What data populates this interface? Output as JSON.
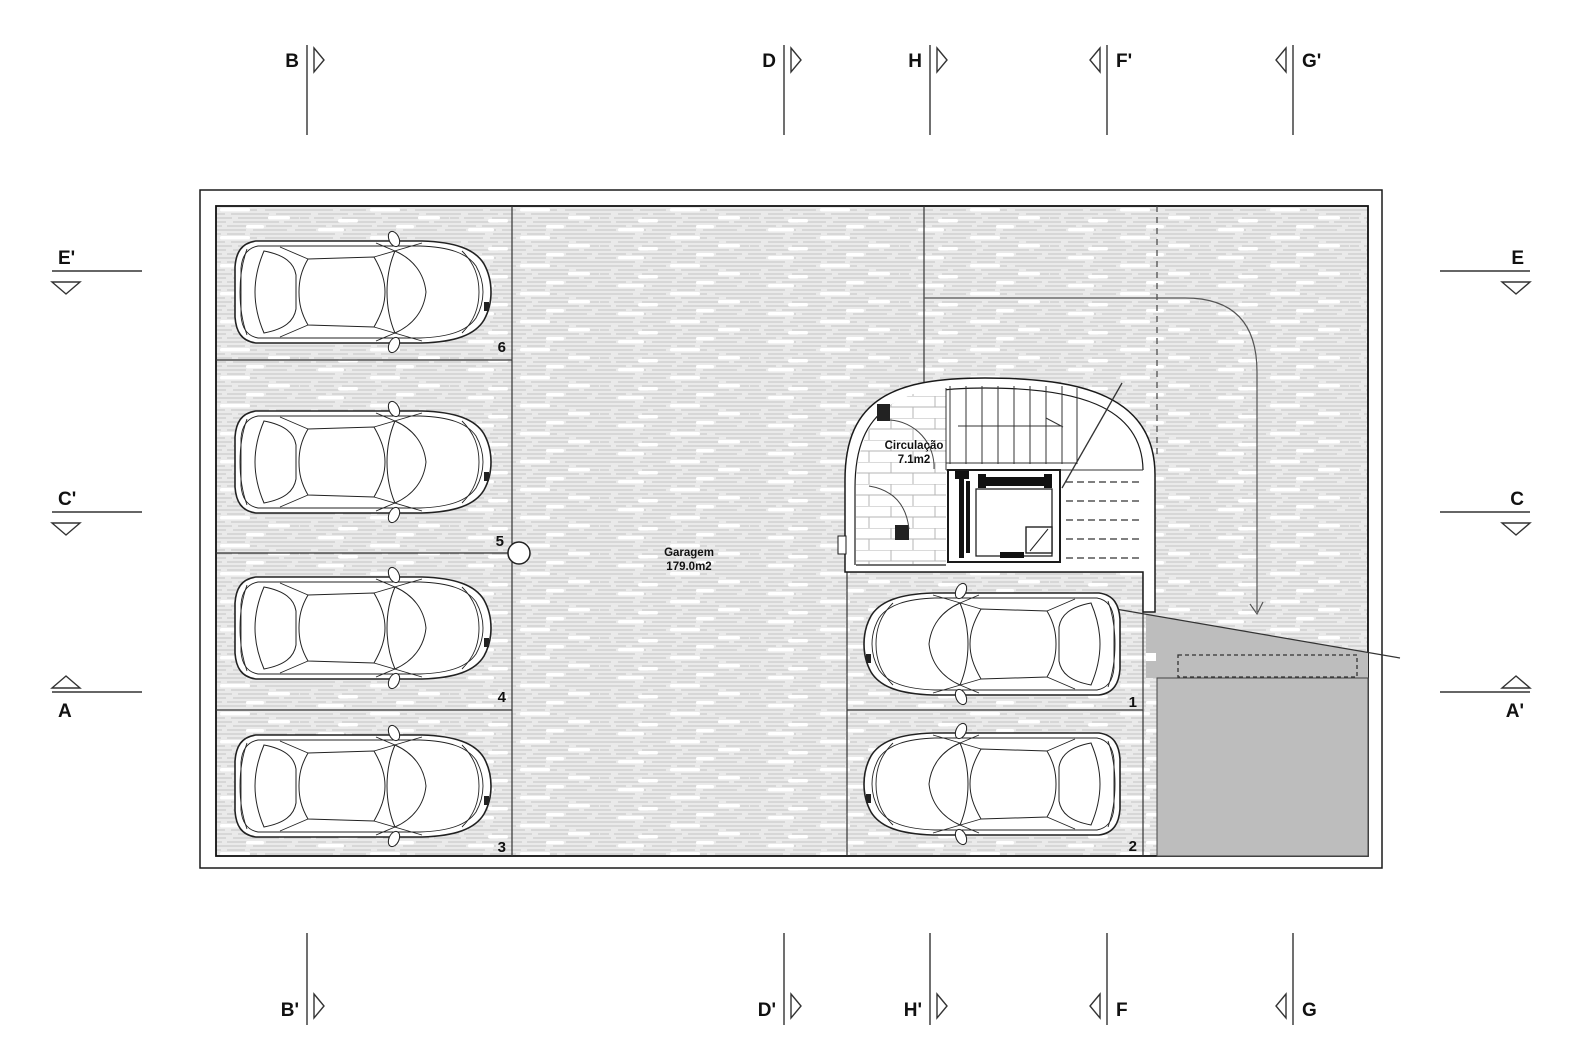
{
  "drawing": {
    "garage_label": {
      "name": "Garagem",
      "area": "179.0m2"
    },
    "circulation_label": {
      "name": "Circulação",
      "area": "7.1m2"
    },
    "stall_numbers": {
      "s6": "6",
      "s5": "5",
      "s4": "4",
      "s3": "3",
      "s1": "1",
      "s2": "2"
    },
    "section_markers": {
      "top": [
        {
          "label": "B"
        },
        {
          "label": "D"
        },
        {
          "label": "H"
        },
        {
          "label": "F'"
        },
        {
          "label": "G'"
        }
      ],
      "bottom": [
        {
          "label": "B'"
        },
        {
          "label": "D'"
        },
        {
          "label": "H'"
        },
        {
          "label": "F"
        },
        {
          "label": "G"
        }
      ],
      "left": [
        {
          "label": "E'"
        },
        {
          "label": "C'"
        },
        {
          "label": "A"
        }
      ],
      "right": [
        {
          "label": "E"
        },
        {
          "label": "C"
        },
        {
          "label": "A'"
        }
      ]
    },
    "colors": {
      "ramp_fill": "#bdbdbd",
      "wall": "#1a1a1a",
      "floor_bg": "#eaeaea",
      "floor_line": "#c4c4c4"
    }
  }
}
